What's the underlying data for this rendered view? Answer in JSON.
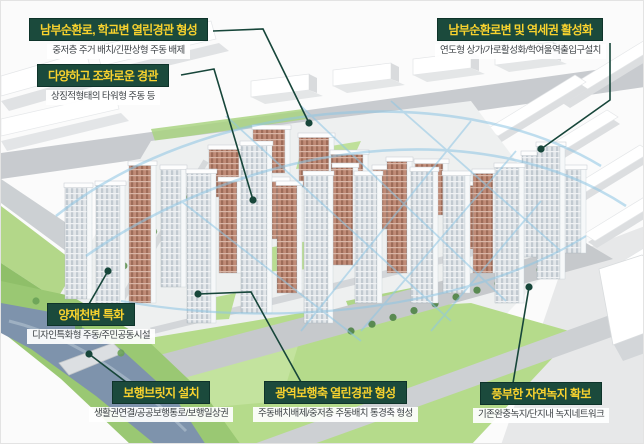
{
  "diagram_title": "apartment-complex-masterplan-annotated-aerial",
  "callouts": [
    {
      "id": "south-ring-school",
      "title": "남부순환로, 학교변 열린경관 형성",
      "subtitle": "중저층 주거 배치/긴판상형 주동 배제"
    },
    {
      "id": "diverse-landscape",
      "title": "다양하고 조화로운 경관",
      "subtitle": "상징적형태의 타워형 주동 등"
    },
    {
      "id": "station-area",
      "title": "남부순환로변 및 역세권 활성화",
      "subtitle": "연도형 상가/가로활성화/학여울역출입구설치"
    },
    {
      "id": "yangjae-stream",
      "title": "양재천변 특화",
      "subtitle": "디자인특화형 주동/주민공동시설"
    },
    {
      "id": "pedestrian-bridge",
      "title": "보행브릿지 설치",
      "subtitle": "생활권연결/공공보행통로/보행일상권"
    },
    {
      "id": "wide-walk-axis",
      "title": "광역보행축 열린경관 형성",
      "subtitle": "주동배치배제/중저층 주동배치 통경축 형성"
    },
    {
      "id": "green-space",
      "title": "풍부한 자연녹지 확보",
      "subtitle": "기존완충녹지/단지내 녹지네트워크"
    }
  ],
  "colors": {
    "callout_bg": "#1b4a3c",
    "callout_title_text": "#f8d22e",
    "callout_subtitle_text": "#3e4347",
    "leader_line": "#17463a",
    "view_corridor_blue": "#8ec6e4",
    "river": "#7e93ac",
    "grass": "#b5db8b",
    "brick_facade": "#c08b77",
    "gray_facade": "#c2cad1"
  }
}
